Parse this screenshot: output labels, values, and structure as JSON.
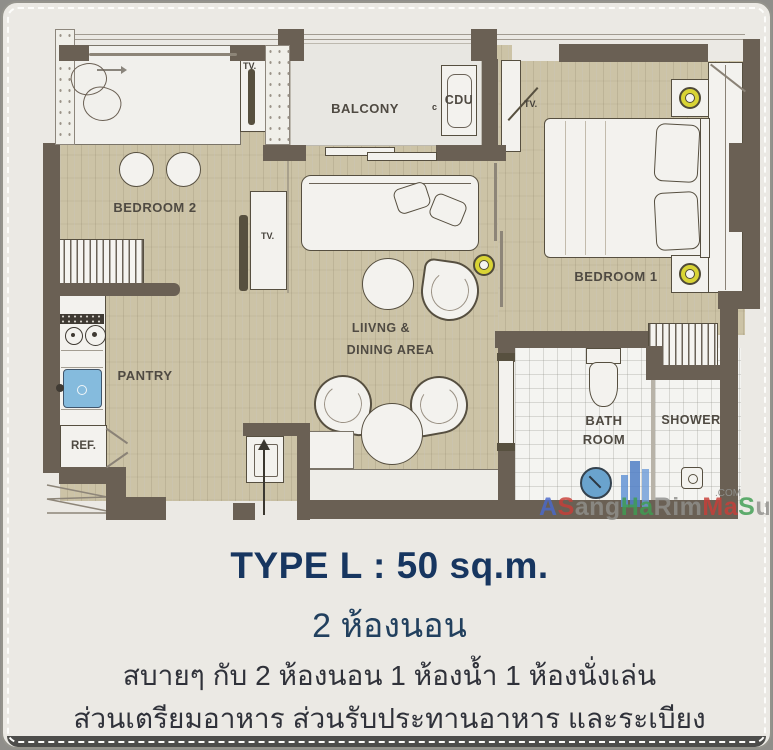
{
  "plan": {
    "labels": {
      "bedroom2": "BEDROOM 2",
      "bedroom1": "BEDROOM 1",
      "balcony": "BALCONY",
      "cdu": "CDU",
      "cdu_small": "c",
      "living_line1": "LIIVNG &",
      "living_line2": "DINING AREA",
      "pantry": "PANTRY",
      "ref": "REF.",
      "bath_line1": "BATH",
      "bath_line2": "ROOM",
      "shower": "SHOWER",
      "tv": "TV."
    },
    "watermark": {
      "suffix": ".COM",
      "segments": [
        {
          "text": "A",
          "color": "#4a69cc"
        },
        {
          "text": "S",
          "color": "#c93f38"
        },
        {
          "text": "ang",
          "color": "#90908c"
        },
        {
          "text": "Ha",
          "color": "#3f9e52"
        },
        {
          "text": "Rim",
          "color": "#90908c"
        },
        {
          "text": "Ma",
          "color": "#c93f38"
        },
        {
          "text": "S",
          "color": "#3f9e52"
        },
        {
          "text": "ub",
          "color": "#90908c"
        }
      ]
    }
  },
  "caption": {
    "title": "TYPE L : 50 sq.m.",
    "subtitle": "2 ห้องนอน",
    "line1": "สบายๆ กับ 2 ห้องนอน 1 ห้องน้ำ 1 ห้องนั่งเล่น",
    "line2": "ส่วนเตรียมอาหาร ส่วนรับประทานอาหาร และระเบียง"
  },
  "colors": {
    "wall": "#6a6054",
    "wood": "#ccc3a6",
    "navy": "#1d3b60",
    "lamp_yellow": "#d9d435",
    "sink_blue": "#85bbdd"
  }
}
